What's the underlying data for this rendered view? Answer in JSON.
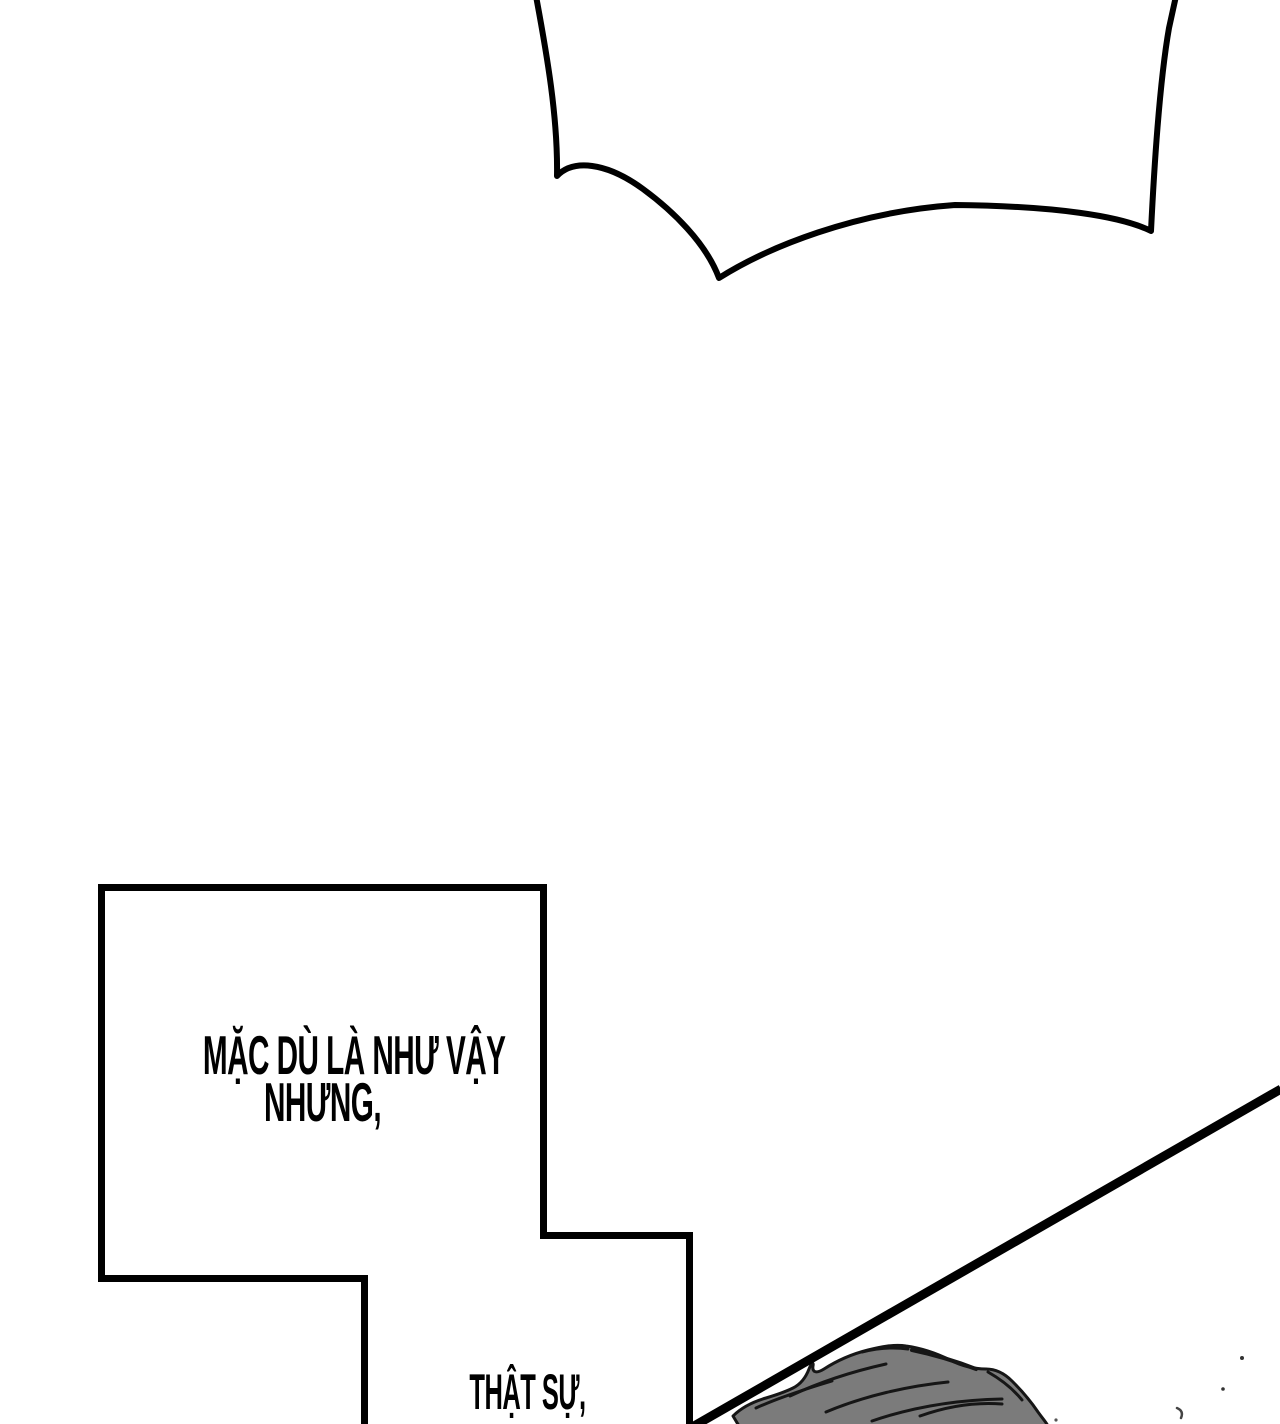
{
  "panel_caption": {
    "line1": "MẶC DÙ LÀ NHƯ VẬY",
    "line2": "NHƯNG,"
  },
  "bottom_caption": {
    "line1": "THẬT SỰ,"
  },
  "colors": {
    "ink": "#000000",
    "paper": "#ffffff",
    "hair_fill": "#7b7b7b",
    "hair_line": "#161616"
  }
}
